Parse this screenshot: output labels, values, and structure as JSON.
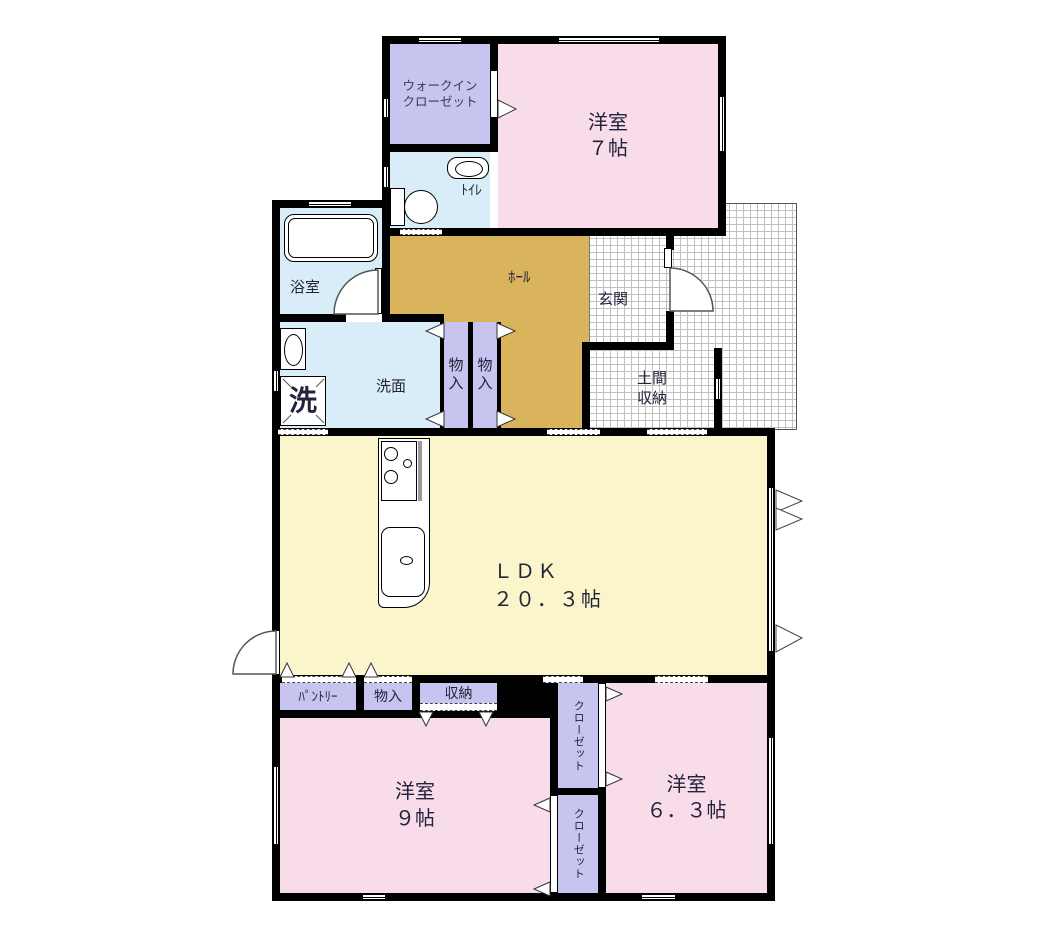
{
  "title": "間取り図",
  "colors": {
    "room_pink": "#F8DCE9",
    "closet_purple": "#C7C4EF",
    "wet_blue": "#D8EDF8",
    "hall_tan": "#D9B45C",
    "ldk_yellow": "#FAF5CB",
    "wall_black": "#000000",
    "tile_line_gray": "#C0C0C0",
    "text_dark": "#23233B"
  },
  "rooms": {
    "walk_in_closet": {
      "label": "ウォークイン\nクローゼット"
    },
    "bedroom7": {
      "label": "洋室\n７帖"
    },
    "toilet": {
      "label": "ﾄｲﾚ"
    },
    "bath": {
      "label": "浴室"
    },
    "hall": {
      "label": "ﾎｰﾙ"
    },
    "entrance": {
      "label": "玄関"
    },
    "doma_storage": {
      "label": "土間\n収納"
    },
    "storage_a": {
      "label": "物\n入"
    },
    "storage_b": {
      "label": "物\n入"
    },
    "washroom": {
      "label": "洗面"
    },
    "washer": {
      "label": "洗"
    },
    "ldk": {
      "label": "ＬＤＫ\n２０．３帖"
    },
    "pantry": {
      "label": "ﾊﾟﾝﾄﾘｰ"
    },
    "storage_c": {
      "label": "物入"
    },
    "storage_d": {
      "label": "収納"
    },
    "bedroom9": {
      "label": "洋室\n９帖"
    },
    "closet_upper": {
      "label": "クローゼット"
    },
    "closet_lower": {
      "label": "クローゼット"
    },
    "bedroom63": {
      "label": "洋室\n６．３帖"
    }
  }
}
